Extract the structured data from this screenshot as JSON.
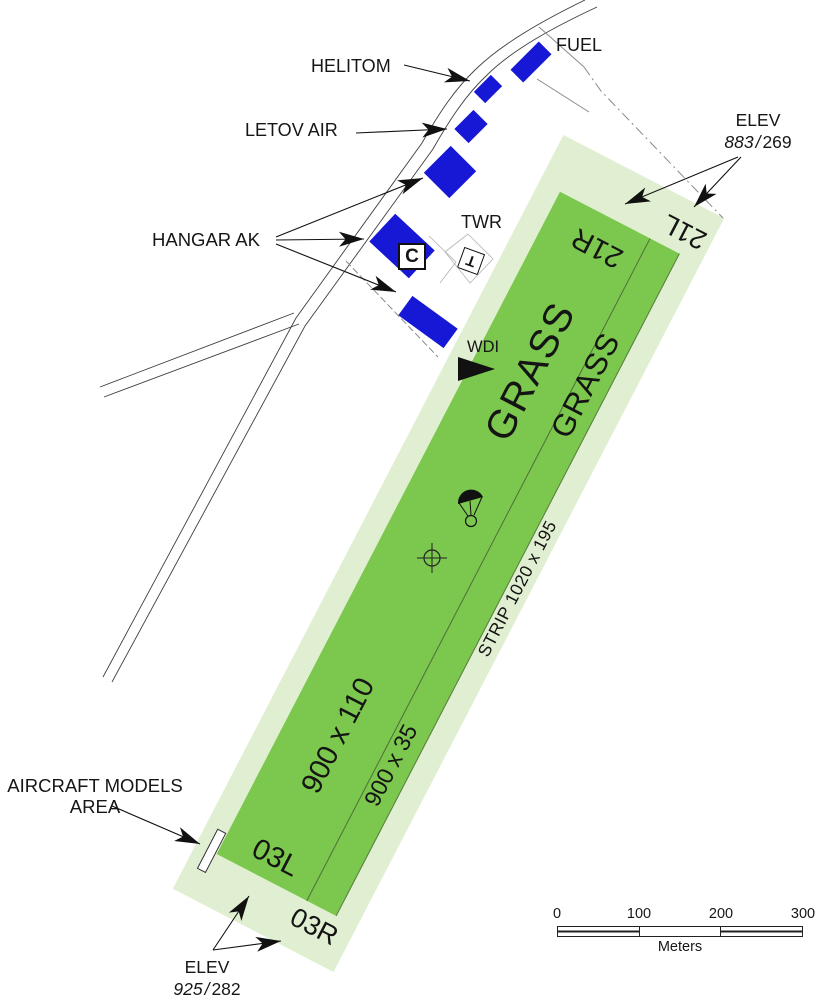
{
  "labels": {
    "fuel": "FUEL",
    "helitom": "HELITOM",
    "letov_air": "LETOV AIR",
    "hangar_ak": "HANGAR AK",
    "twr": "TWR",
    "wdi": "WDI",
    "hangar_c_code": "C",
    "twr_symbol": "T",
    "models_line1": "AIRCRAFT MODELS",
    "models_line2": "AREA"
  },
  "strip": {
    "grass_main": "GRASS",
    "grass_secondary": "GRASS",
    "runway_main_dim": "900 x 110",
    "runway_secondary_dim": "900 x 35",
    "strip_dim": "STRIP 1020 x 195",
    "designators": {
      "r21r": "21R",
      "r21l": "21L",
      "r03l": "03L",
      "r03r": "03R"
    }
  },
  "elevation_top": {
    "label": "ELEV",
    "feet": "883",
    "sep": "/",
    "meters": "269"
  },
  "elevation_bottom": {
    "label": "ELEV",
    "feet": "925",
    "sep": "/",
    "meters": "282"
  },
  "scale_bar": {
    "ticks": [
      "0",
      "100",
      "200",
      "300"
    ],
    "unit": "Meters"
  },
  "colors": {
    "runway_green": "#7cc74d",
    "strip_pale": "#e0efd1",
    "building_blue": "#1717d6",
    "line": "#1a1a1a"
  }
}
